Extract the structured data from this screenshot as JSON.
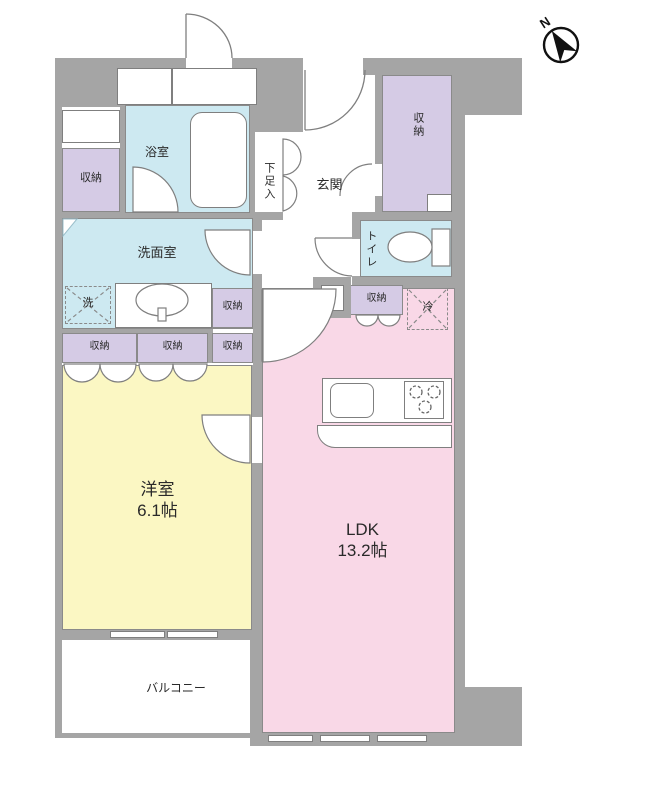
{
  "title": "floor-plan",
  "compass": {
    "north_label": "N"
  },
  "rooms": {
    "western_room": {
      "label": "洋室",
      "size": "6.1帖"
    },
    "ldk": {
      "label": "LDK",
      "size": "13.2帖"
    },
    "balcony": {
      "label": "バルコニー"
    },
    "bathroom": {
      "label": "浴室"
    },
    "washroom": {
      "label": "洗面室"
    },
    "toilet": {
      "label": "トイレ"
    },
    "entrance": {
      "label": "玄関"
    },
    "shoe_cabinet": {
      "label": "下足入"
    },
    "storage": {
      "label": "収納"
    },
    "washer": {
      "label": "洗"
    },
    "fridge": {
      "label": "冷"
    }
  },
  "colors": {
    "wall": "#a5a5a5",
    "western_room": "#fbf7c3",
    "ldk": "#f9d8e7",
    "wet_area": "#cde9f1",
    "storage": "#d5cbe5",
    "outline": "#7f7f7f"
  }
}
